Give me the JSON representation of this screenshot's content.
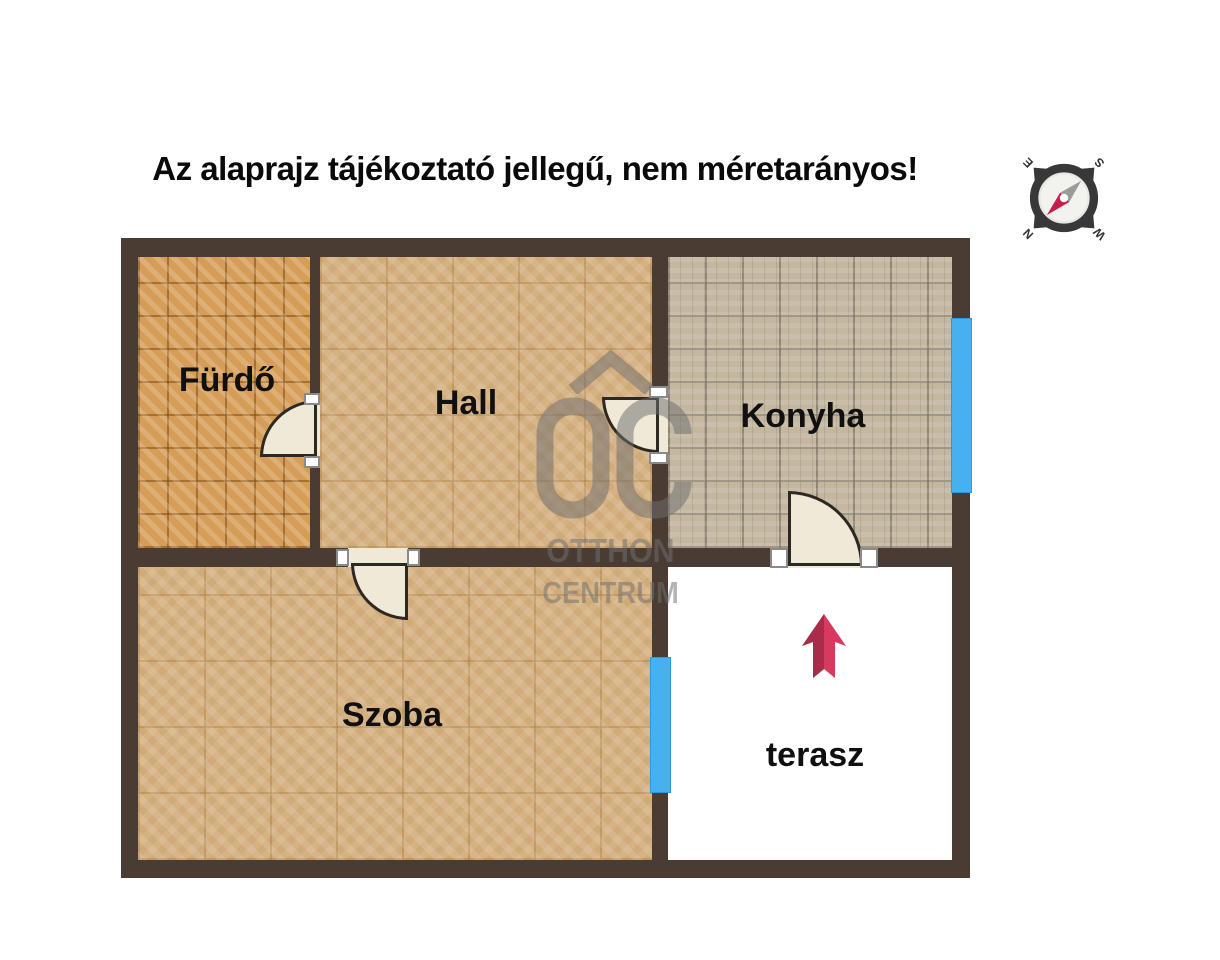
{
  "title": "Az alaprajz tájékoztató jellegű, nem méretarányos!",
  "plan": {
    "rooms": [
      {
        "id": "furdo",
        "label": "Fürdő",
        "floor_texture": "orange-tile"
      },
      {
        "id": "hall",
        "label": "Hall",
        "floor_texture": "parquet"
      },
      {
        "id": "konyha",
        "label": "Konyha",
        "floor_texture": "grey-brick-tile"
      },
      {
        "id": "szoba",
        "label": "Szoba",
        "floor_texture": "parquet"
      },
      {
        "id": "terasz",
        "label": "terasz",
        "floor_texture": "plain-white"
      }
    ],
    "windows": [
      {
        "room": "Konyha",
        "wall": "east"
      },
      {
        "room": "Szoba",
        "wall": "east"
      }
    ],
    "doors": [
      {
        "between": [
          "Fürdő",
          "Hall"
        ]
      },
      {
        "between": [
          "Hall",
          "Konyha"
        ]
      },
      {
        "between": [
          "Hall",
          "Szoba"
        ]
      },
      {
        "between": [
          "Konyha",
          "terasz"
        ]
      }
    ],
    "entrance_arrow": {
      "room": "terasz",
      "direction": "up"
    }
  },
  "watermark": {
    "logo": "OC",
    "line1": "OTTHON",
    "line2": "CENTRUM"
  },
  "compass": {
    "rotation_deg": -135,
    "letters": {
      "n": "N",
      "e": "E",
      "s": "S",
      "w": "W"
    }
  },
  "colors": {
    "wall": "#4a3c33",
    "furdo_floor": "#d59d58",
    "parquet_floor": "#d6b282",
    "konyha_floor": "#c3b7a0",
    "terasz_floor": "#ffffff",
    "window_blue": "#47b1ef",
    "door_cream": "#f1e9d8",
    "arrow_red": "#d63a5f",
    "arrow_red_dark": "#a92d4b",
    "watermark_grey": "#6f6f6f",
    "compass_needle_red": "#c71f4a",
    "compass_needle_grey": "#9b9b9b"
  }
}
